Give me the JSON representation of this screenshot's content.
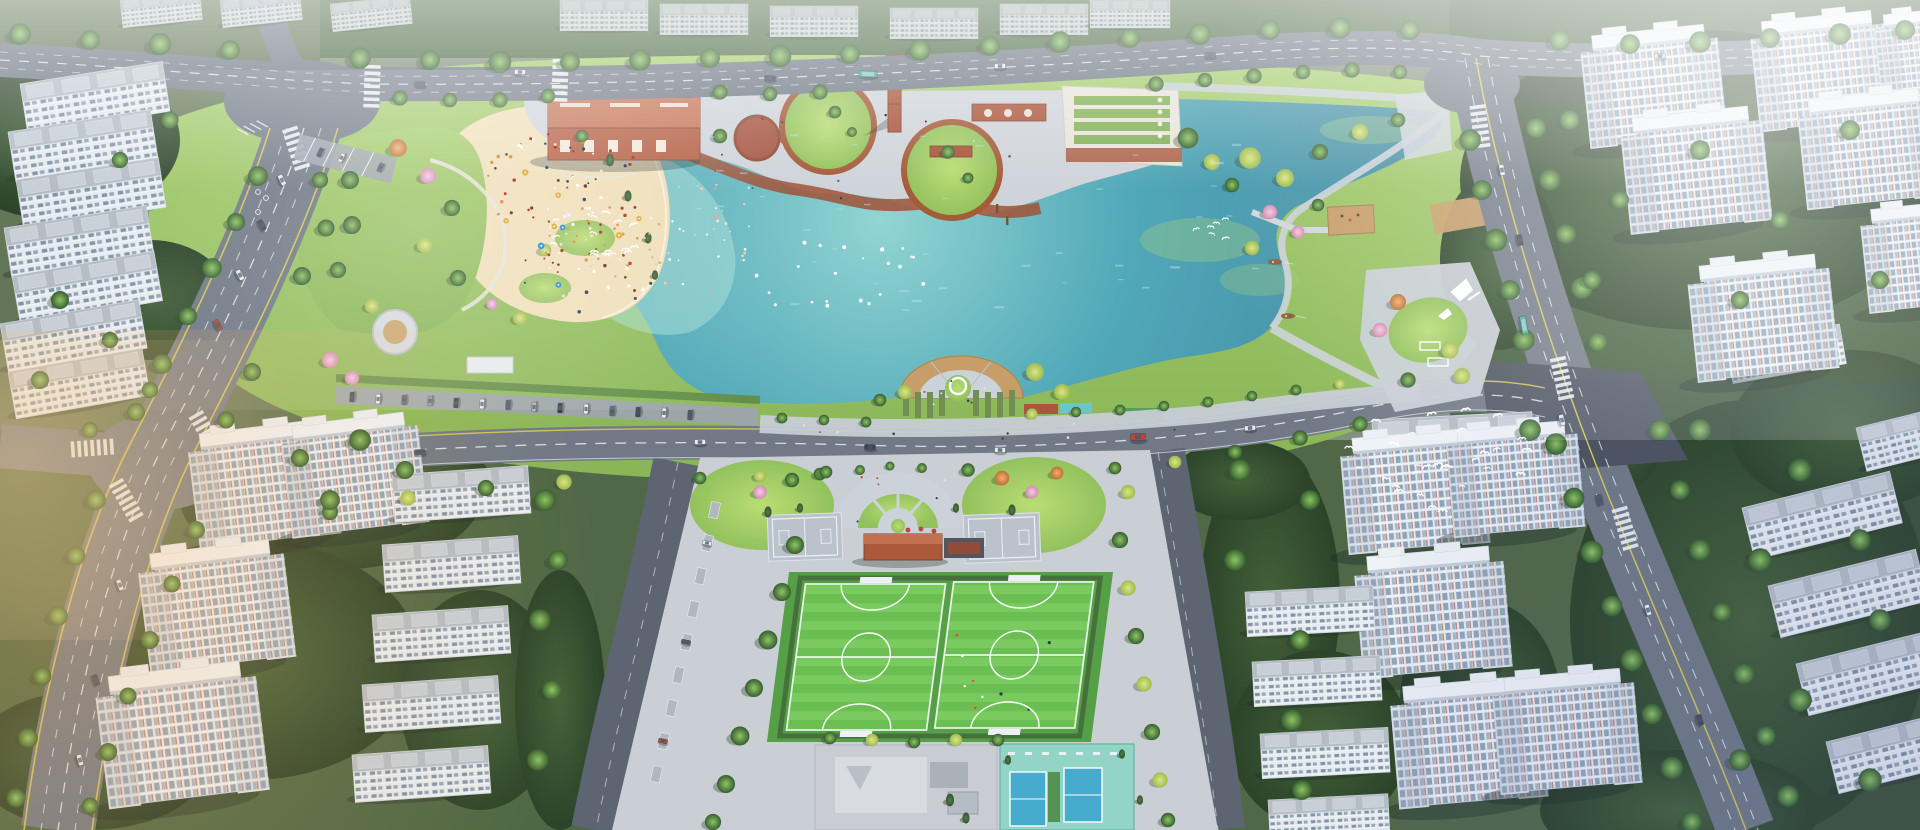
{
  "scene": {
    "title": "Aerial rendering of a lakeside urban park masterplan",
    "setting": "hazy daylight, bird's-eye oblique view",
    "features": [
      "turquoise city lake with swimming beach",
      "sand beach crowded with sunbathers and umbrellas",
      "industrial-heritage plaza with red brick hall, brick chimney and green-roof building",
      "two circular lawn mounds with brown ring paths",
      "semicircular lakeside overlook deck with white ring sculpture",
      "zigzag timber boardwalk pier with platform and rowing boats",
      "two artificial-turf football pitches",
      "two basketball pads and red brick pavilion at sports entrance",
      "blue tennis courts on teal pad and grey skate yard",
      "tree-lined avenues with lane markings, crosswalks and parking bays",
      "white residential high-rise towers and mid-rise slab housing",
      "flocks of white birds over lake and southeast junction"
    ],
    "counts": {
      "boats": 2,
      "football_pitches": 2,
      "tennis_courts": 2,
      "lawn_circles": 2,
      "towers_southwest": 3,
      "towers_southeast": 3
    }
  },
  "colors": {
    "ground": "#7c8a74",
    "park_grass_light": "#a3cc66",
    "park_grass": "#86b350",
    "lawn_bright": "#aad45f",
    "forest_dark": "#2e4527",
    "forest_mid": "#41603a",
    "lake_shallow": "#8fd4d2",
    "lake_mid": "#4aa5b6",
    "lake_deep": "#39839c",
    "sand": "#f2dfb8",
    "sand_warm": "#f7e9c8",
    "asphalt": "#6b7380",
    "asphalt_dark": "#565e6b",
    "junction_dark": "#454c59",
    "line_white": "#eef1f5",
    "line_yellow": "#d9c94a",
    "paver": "#cfd3da",
    "paver_mid": "#c6cbd4",
    "brick_red": "#b4593c",
    "brick_dark": "#a84c30",
    "roof_red": "#c66f4e",
    "green_roof": "#7fae4e",
    "turf_a": "#66bd4a",
    "turf_b": "#74ca58",
    "turf_apron": "#4f9c3e",
    "court_pad": "#8fd3c3",
    "court_blue": "#3fa8cc",
    "deck_wood": "#c79a62",
    "building_white": "#e9edf3",
    "roof_white": "#f1f4f8",
    "window_glass": "#8ea2b6",
    "accent_red": "#b05a42",
    "bird_white": "#ffffff",
    "boat_brown": "#8a5a33",
    "haze_cool": "#ffffff",
    "glow_warm": "#ffb86a"
  },
  "scatter": [
    {
      "name": "beach-crowd-upper",
      "kind": "dot",
      "shape": "ellipse",
      "cx": 565,
      "cy": 185,
      "rx": 82,
      "ry": 52,
      "count": 70,
      "sizeMin": 0.9,
      "sizeMax": 1.8,
      "colors": [
        "#b5543b",
        "#ece5d8",
        "#3a5a7a",
        "#d9a05a",
        "#7a4a3a",
        "#ffffff",
        "#c2452f"
      ],
      "seed": 7
    },
    {
      "name": "beach-crowd-lower",
      "kind": "dot",
      "shape": "ellipse",
      "cx": 588,
      "cy": 268,
      "rx": 70,
      "ry": 45,
      "count": 64,
      "sizeMin": 0.9,
      "sizeMax": 1.8,
      "colors": [
        "#b5543b",
        "#ece5d8",
        "#3a5a7a",
        "#d9a05a",
        "#7a4a3a",
        "#ffffff"
      ],
      "seed": 19
    },
    {
      "name": "swimmers",
      "kind": "dot",
      "shape": "ellipse",
      "cx": 702,
      "cy": 240,
      "rx": 58,
      "ry": 58,
      "count": 46,
      "sizeMin": 0.8,
      "sizeMax": 1.5,
      "colors": [
        "#f2e4cc",
        "#ffffff",
        "#d9b08c",
        "#e8d2b5"
      ],
      "seed": 33
    },
    {
      "name": "waterfowl-on-water",
      "kind": "dot",
      "shape": "ellipse",
      "cx": 835,
      "cy": 272,
      "rx": 112,
      "ry": 40,
      "count": 24,
      "sizeMin": 1.1,
      "sizeMax": 2.1,
      "colors": [
        "#ffffff",
        "#f2f6f8"
      ],
      "seed": 41
    },
    {
      "name": "lake-sparkle",
      "kind": "dash",
      "shape": "rect",
      "x": 680,
      "y": 130,
      "w": 580,
      "h": 180,
      "count": 44,
      "sizeMin": 2,
      "sizeMax": 4.6,
      "colors": [
        "#bfe6ea"
      ],
      "opacity": 0.45,
      "seed": 55
    },
    {
      "name": "bird-flock-west",
      "kind": "bird",
      "shape": "ellipse",
      "cx": 596,
      "cy": 233,
      "rx": 52,
      "ry": 26,
      "count": 19,
      "sizeMin": 0.8,
      "sizeMax": 1.4,
      "colors": [
        "#ffffff"
      ],
      "seed": 61
    },
    {
      "name": "bird-flock-southeast",
      "kind": "bird",
      "shape": "ellipse",
      "cx": 1448,
      "cy": 462,
      "rx": 115,
      "ry": 55,
      "count": 30,
      "sizeMin": 0.9,
      "sizeMax": 1.6,
      "colors": [
        "#ffffff"
      ],
      "seed": 77
    },
    {
      "name": "bird-flock-northeast",
      "kind": "bird",
      "shape": "ellipse",
      "cx": 1220,
      "cy": 230,
      "rx": 26,
      "ry": 13,
      "count": 6,
      "sizeMin": 0.8,
      "sizeMax": 1.2,
      "colors": [
        "#ffffff"
      ],
      "seed": 83
    },
    {
      "name": "beach-umbrellas",
      "kind": "umbrella",
      "shape": "ellipse",
      "cx": 575,
      "cy": 225,
      "rx": 76,
      "ry": 70,
      "count": 10,
      "sizeMin": 2.6,
      "sizeMax": 3.4,
      "colors": [
        "#4d9fd6",
        "#e8e8e8",
        "#e8b54d"
      ],
      "seed": 91
    },
    {
      "name": "plaza-people",
      "kind": "dot",
      "shape": "rect",
      "x": 700,
      "y": 115,
      "w": 360,
      "h": 95,
      "count": 12,
      "sizeMin": 0.9,
      "sizeMax": 1.4,
      "colors": [
        "#3a3f4a",
        "#b5543b",
        "#e8e2d6",
        "#5a6a7a"
      ],
      "seed": 101
    },
    {
      "name": "promenade-people",
      "kind": "dot",
      "shape": "rect",
      "x": 760,
      "y": 418,
      "w": 480,
      "h": 22,
      "count": 9,
      "sizeMin": 0.9,
      "sizeMax": 1.3,
      "colors": [
        "#3a3f4a",
        "#b5543b",
        "#e8e2d6"
      ],
      "seed": 117
    },
    {
      "name": "pitch-players",
      "kind": "dot",
      "shape": "rect",
      "x": 950,
      "y": 600,
      "w": 130,
      "h": 110,
      "count": 9,
      "sizeMin": 1.2,
      "sizeMax": 1.8,
      "colors": [
        "#e84c3d",
        "#ffffff",
        "#2c3e50"
      ],
      "seed": 131
    },
    {
      "name": "entry-people",
      "kind": "dot",
      "shape": "rect",
      "x": 848,
      "y": 470,
      "w": 105,
      "h": 55,
      "count": 6,
      "sizeMin": 0.9,
      "sizeMax": 1.3,
      "colors": [
        "#3a3f4a",
        "#b5543b",
        "#e8e2d6"
      ],
      "seed": 151
    },
    {
      "name": "overlook-people",
      "kind": "dot",
      "shape": "ellipse",
      "cx": 960,
      "cy": 390,
      "rx": 40,
      "ry": 22,
      "count": 7,
      "sizeMin": 0.9,
      "sizeMax": 1.3,
      "colors": [
        "#3a3f4a",
        "#c2452f",
        "#e8e2d6"
      ],
      "seed": 163
    }
  ]
}
